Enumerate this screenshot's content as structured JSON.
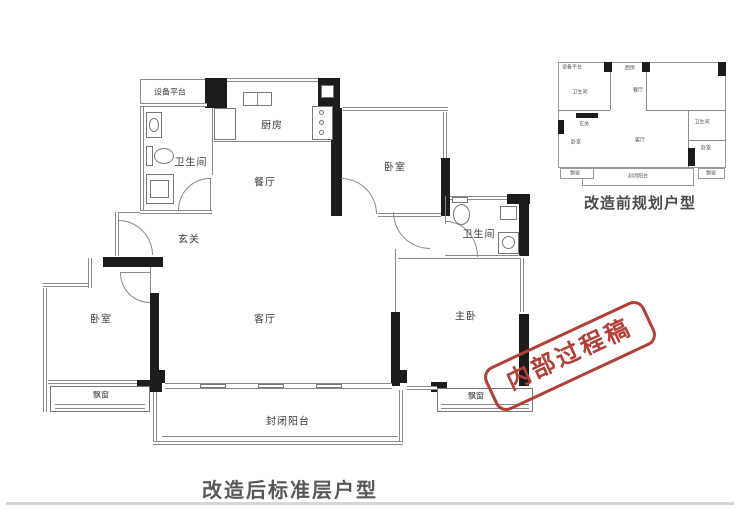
{
  "main_plan": {
    "rooms": {
      "equipment_platform": "设备平台",
      "bathroom_left": "卫生间",
      "kitchen": "厨房",
      "dining": "餐厅",
      "bedroom_top": "卧室",
      "entry": "玄关",
      "bathroom_right": "卫生间",
      "bedroom_left": "卧室",
      "living": "客厅",
      "master_bedroom": "主卧",
      "bay_window_left": "飘窗",
      "bay_window_right": "飘窗",
      "balcony": "封闭阳台"
    },
    "caption": "改造后标准层户型"
  },
  "mini_plan": {
    "caption": "改造前规划户型",
    "labels": [
      "设备平台",
      "厨房",
      "卫生间",
      "餐厅",
      "玄关",
      "卧室",
      "客厅",
      "卫生间",
      "卧室",
      "飘窗",
      "封闭阳台",
      "飘窗"
    ]
  },
  "stamp": {
    "text": "内部过程稿",
    "color": "#b04038"
  },
  "colors": {
    "wall": "#1c1c1c",
    "line": "#8a8a8a",
    "label": "#3a3a3a",
    "caption": "#575757",
    "divider": "#d6d6d6"
  }
}
